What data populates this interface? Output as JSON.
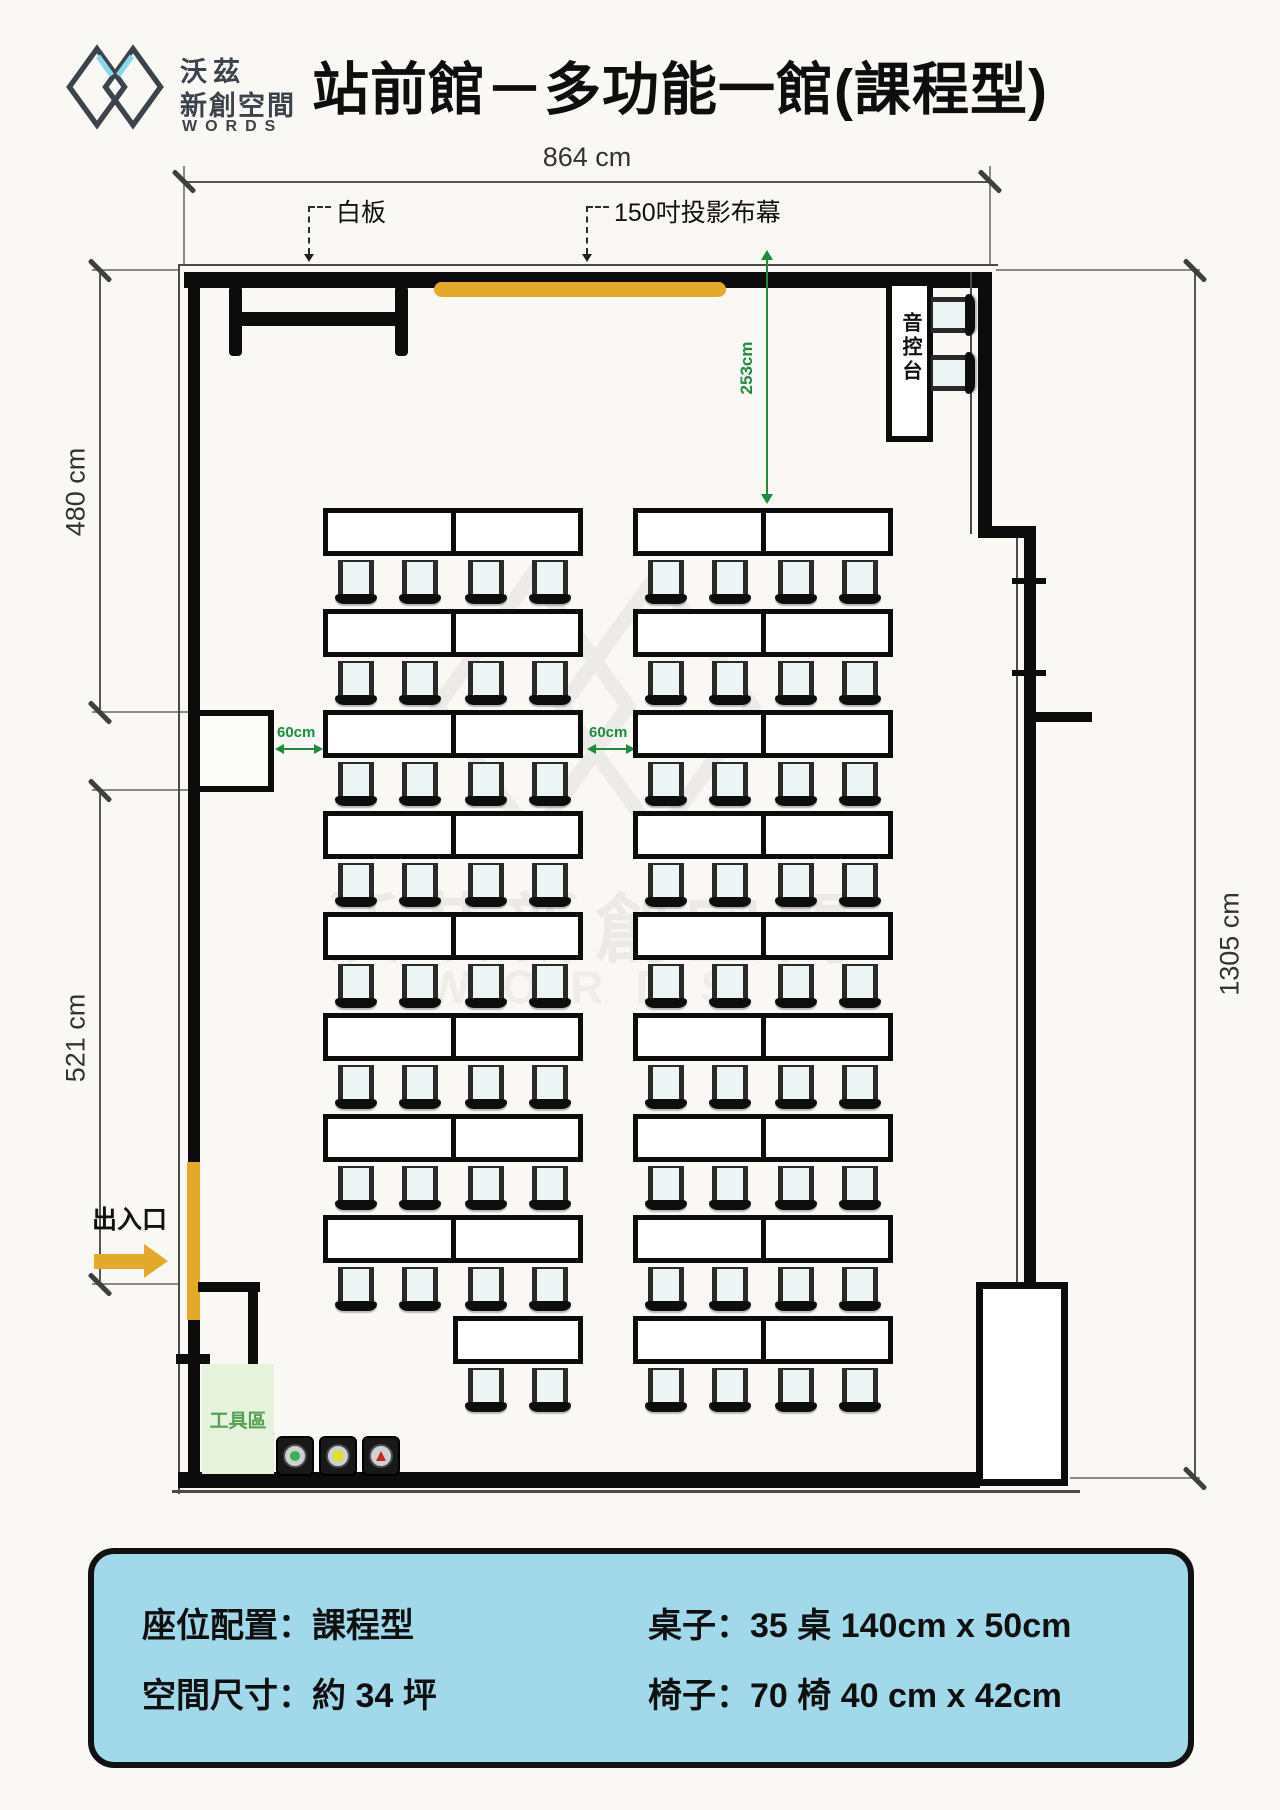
{
  "header": {
    "logo_cjk_1": "沃茲",
    "logo_cjk_2": "新創空間",
    "logo_latin": "WORDS",
    "title": "站前館－多功能一館(課程型)"
  },
  "floorplan": {
    "dimensions": {
      "top": "864 cm",
      "left_upper": "480 cm",
      "left_lower": "521 cm",
      "right": "1305 cm",
      "screen_to_seats": "253cm",
      "aisle_left": "60cm",
      "aisle_center": "60cm"
    },
    "labels": {
      "whiteboard": "白板",
      "projection_screen": "150吋投影布幕",
      "audio_console": "音控台",
      "entrance": "出入口",
      "tool_area": "工具區"
    },
    "furniture": {
      "left_double_rows": 8,
      "right_double_rows": 9,
      "left_single_tables": 1,
      "chairs_per_table": 2,
      "console_chairs": 2,
      "speaker_lights": [
        {
          "shape": "circle",
          "color": "#3cb054"
        },
        {
          "shape": "square",
          "color": "#e4dd2b"
        },
        {
          "shape": "triangle",
          "color": "#c92525"
        }
      ]
    },
    "colors": {
      "accent_yellow": "#e3a92b",
      "dimension_green": "#1f8b3e",
      "tool_area_fill": "#e7f2dc",
      "tool_area_text": "#55a055",
      "info_box_fill": "#a2d9ea"
    }
  },
  "watermark": {
    "cjk": "沃茲新創空間",
    "latin": "WORDS"
  },
  "info_box": {
    "seating": "座位配置：課程型",
    "space": "空間尺寸：約 34 坪",
    "tables": "桌子：35 桌  140cm x 50cm",
    "chairs": "椅子：70 椅  40 cm x 42cm"
  }
}
